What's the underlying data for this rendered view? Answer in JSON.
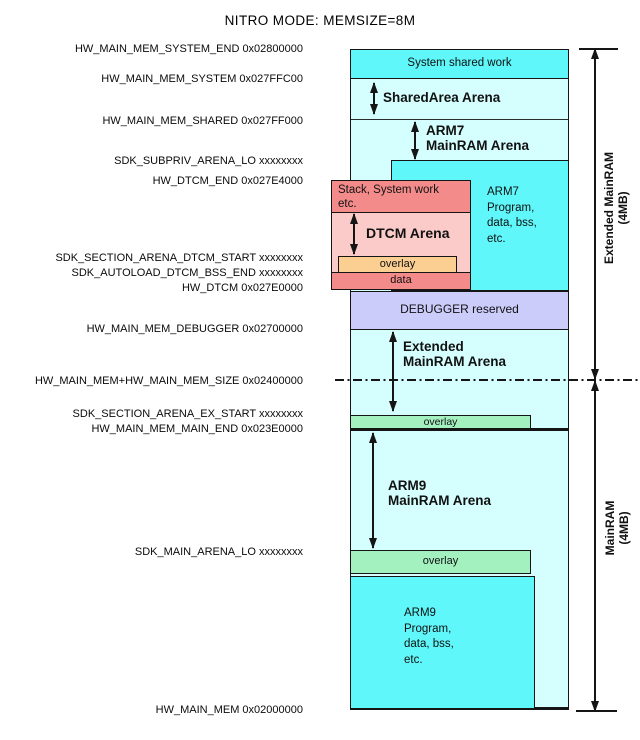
{
  "title": "NITRO MODE: MEMSIZE=8M",
  "left_labels": [
    {
      "text": "HW_MAIN_MEM_SYSTEM_END 0x02800000"
    },
    {
      "text": "HW_MAIN_MEM_SYSTEM 0x027FFC00"
    },
    {
      "text": "HW_MAIN_MEM_SHARED 0x027FF000"
    },
    {
      "text": "SDK_SUBPRIV_ARENA_LO xxxxxxxx"
    },
    {
      "text": "HW_DTCM_END 0x027E4000"
    },
    {
      "text": "SDK_SECTION_ARENA_DTCM_START xxxxxxxx"
    },
    {
      "text": "SDK_AUTOLOAD_DTCM_BSS_END xxxxxxxx"
    },
    {
      "text": "HW_DTCM 0x027E0000"
    },
    {
      "text": "HW_MAIN_MEM_DEBUGGER 0x02700000"
    },
    {
      "text": "HW_MAIN_MEM+HW_MAIN_MEM_SIZE 0x02400000"
    },
    {
      "text": "SDK_SECTION_ARENA_EX_START xxxxxxxx"
    },
    {
      "text": "HW_MAIN_MEM_MAIN_END 0x023E0000"
    },
    {
      "text": "SDK_MAIN_ARENA_LO xxxxxxxx"
    },
    {
      "text": "HW_MAIN_MEM 0x02000000"
    }
  ],
  "diagram": {
    "system_shared_work": "System shared work",
    "sharedarea_arena": "SharedArea Arena",
    "arm7_arena_lines": [
      "ARM7",
      "MainRAM Arena"
    ],
    "arm7_program_lines": [
      "ARM7",
      "Program,",
      "data, bss,",
      "etc."
    ],
    "stack_lines": [
      "Stack, System work",
      "etc."
    ],
    "dtcm_arena": "DTCM Arena",
    "dtcm_overlay": "overlay",
    "dtcm_data": "data",
    "debugger": "DEBUGGER reserved",
    "extended_arena_lines": [
      "Extended",
      "MainRAM Arena"
    ],
    "overlay_ex": "overlay",
    "arm9_arena_lines": [
      "ARM9",
      "MainRAM Arena"
    ],
    "overlay_main": "overlay",
    "arm9_program_lines": [
      "ARM9",
      "Program,",
      "data, bss,",
      "etc."
    ]
  },
  "right_measures": {
    "extended_lines": [
      "Extended MainRAM",
      "(4MB)"
    ],
    "mainram_lines": [
      "MainRAM",
      "(4MB)"
    ]
  },
  "colors": {
    "bright_cyan": "#5ff7f9",
    "pale_cyan": "#d5feff",
    "purple": "#ccccfb",
    "salmon": "#f48b8b",
    "light_pink": "#fbcbc9",
    "orange": "#fbce92",
    "green": "#a4f1c0",
    "line": "#151515"
  }
}
